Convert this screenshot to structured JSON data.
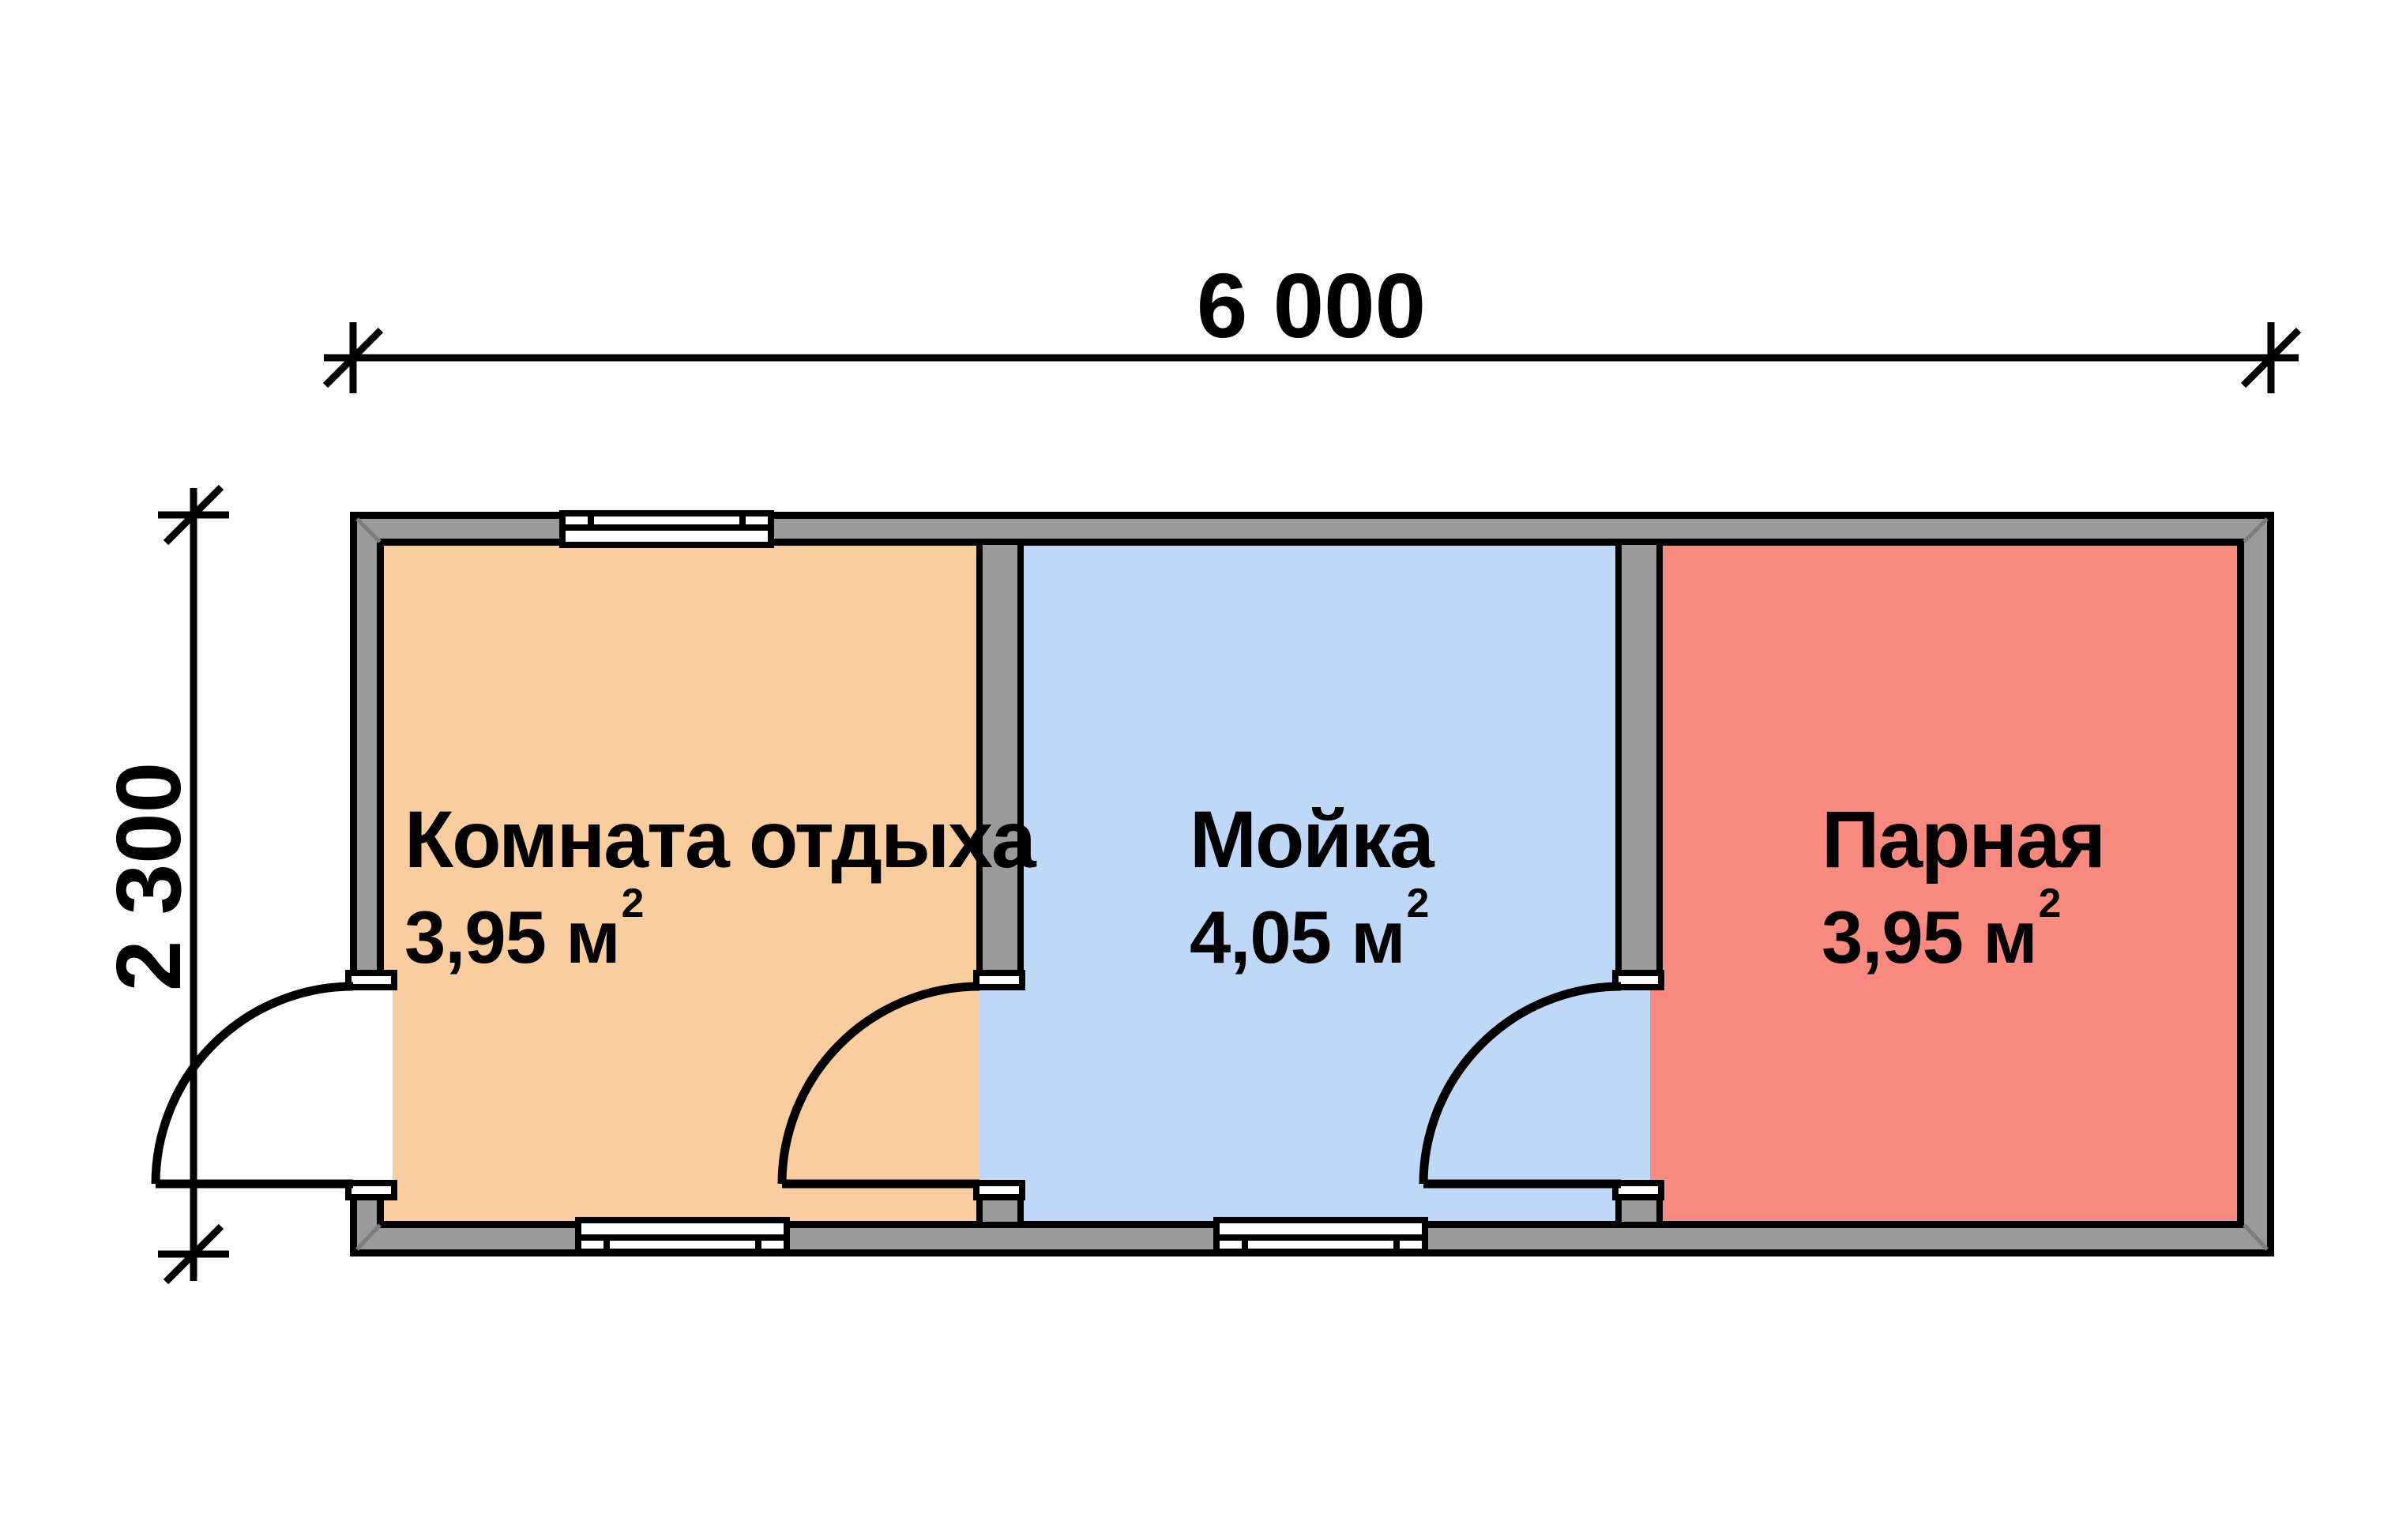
{
  "plan": {
    "type": "floor-plan",
    "dimensions": {
      "width_label": "6 000",
      "height_label": "2 300"
    },
    "rooms": [
      {
        "name": "Комната отдыха",
        "area_value": "3,95 м",
        "area_sup": "2",
        "fill": "#facd9e"
      },
      {
        "name": "Мойка",
        "area_value": "4,05 м",
        "area_sup": "2",
        "fill": "#bfd8f8"
      },
      {
        "name": "Парная",
        "area_value": "3,95 м",
        "area_sup": "2",
        "fill": "#fa8a80"
      }
    ],
    "colors": {
      "wall_gray": "#9a9a9a",
      "outline_black": "#000000",
      "background": "#ffffff"
    },
    "features": {
      "windows": 3,
      "doors": 3,
      "door_symbol": "quarter-circle swing arc"
    }
  }
}
